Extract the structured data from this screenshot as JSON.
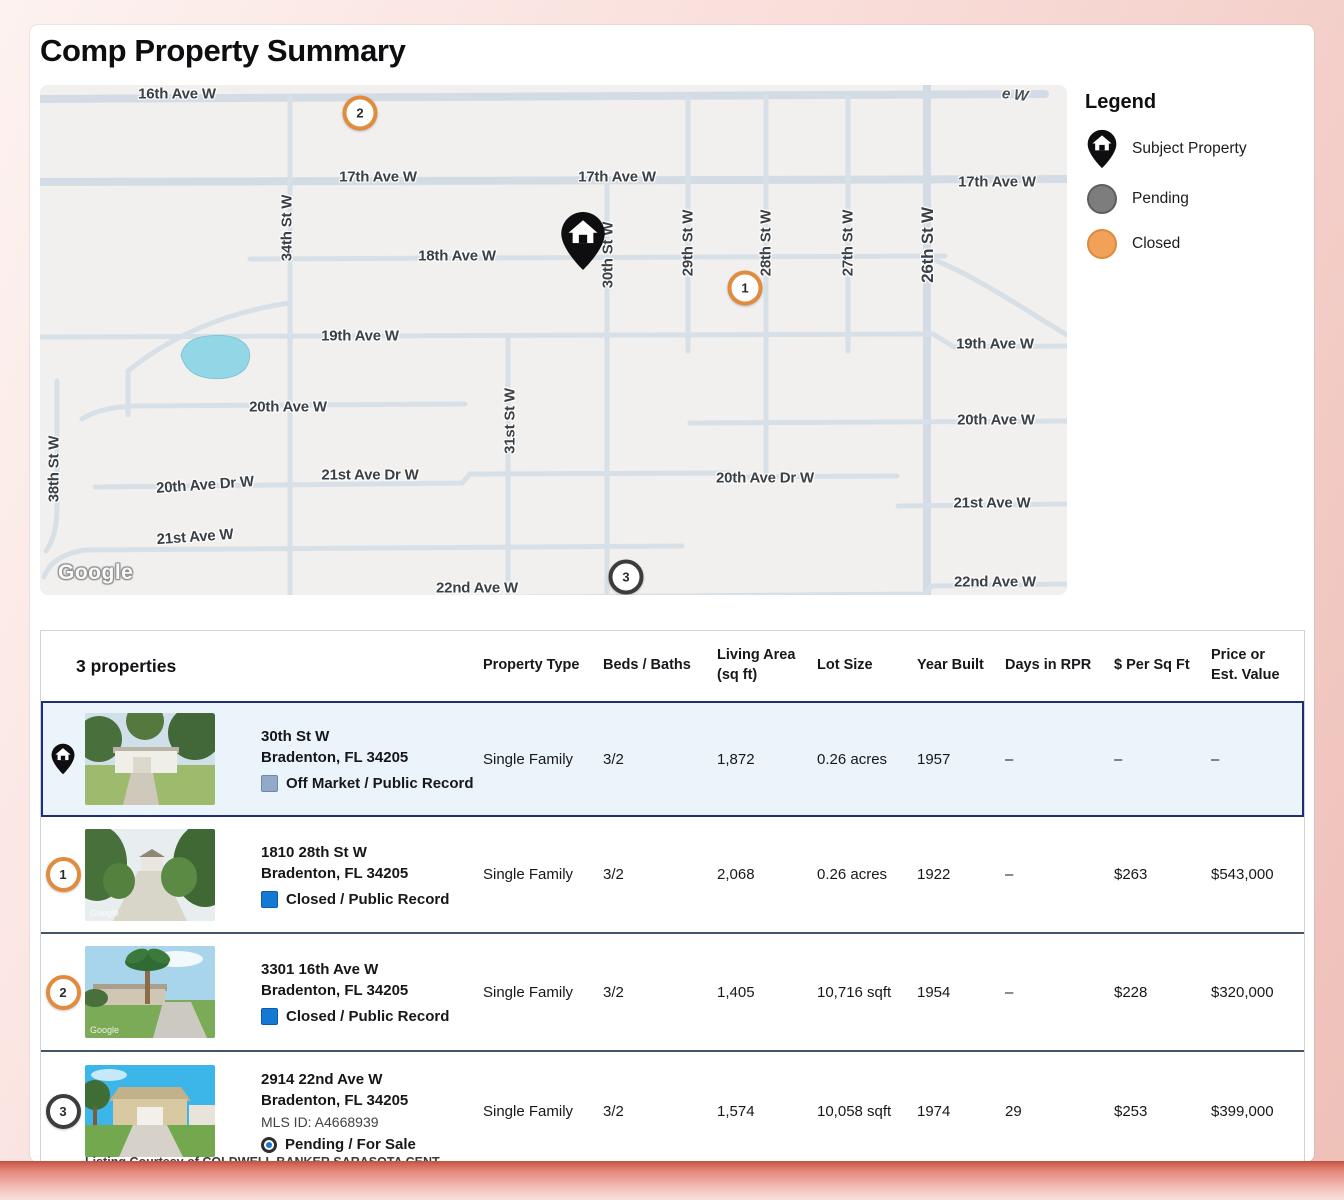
{
  "page_title": "Comp Property Summary",
  "map": {
    "google_logo": "Google",
    "street_labels": [
      "16th Ave W",
      "e W",
      "17th Ave W",
      "17th Ave W",
      "17th Ave W",
      "18th Ave W",
      "19th Ave W",
      "19th Ave W",
      "20th Ave W",
      "20th Ave W",
      "20th Ave Dr W",
      "21st Ave Dr W",
      "20th Ave Dr W",
      "21st Ave W",
      "21st Ave W",
      "22nd Ave W",
      "22nd Ave W",
      "38th St W",
      "34th St W",
      "31st St W",
      "30th St W",
      "29th St W",
      "28th St W",
      "27th St W",
      "26th St W"
    ],
    "markers": [
      {
        "label": "1",
        "status": "closed"
      },
      {
        "label": "2",
        "status": "closed"
      },
      {
        "label": "3",
        "status": "pending"
      }
    ]
  },
  "legend": {
    "title": "Legend",
    "items": [
      {
        "icon": "subject-pin",
        "label": "Subject Property"
      },
      {
        "icon": "pending-circle",
        "label": "Pending"
      },
      {
        "icon": "closed-circle",
        "label": "Closed"
      }
    ]
  },
  "colors": {
    "closed_orange": "#e08c3f",
    "pending_gray": "#7d7d7d",
    "selected_row_blue": "#ecf4fb",
    "selection_border_navy": "#1f2d7a"
  },
  "table": {
    "count_label": "3 properties",
    "columns": [
      [
        "Property Type",
        ""
      ],
      [
        "Beds / Baths",
        ""
      ],
      [
        "Living Area",
        "(sq ft)"
      ],
      [
        "Lot Size",
        ""
      ],
      [
        "Year Built",
        ""
      ],
      [
        "Days in RPR",
        ""
      ],
      [
        "$ Per Sq Ft",
        ""
      ],
      [
        "Price or",
        "Est. Value"
      ]
    ],
    "rows": [
      {
        "marker_label": "",
        "address_line1": "30th St W",
        "address_line2": "Bradenton, FL 34205",
        "status": "Off Market / Public Record",
        "property_type": "Single Family",
        "beds_baths": "3/2",
        "living_area": "1,872",
        "lot_size": "0.26 acres",
        "year_built": "1957",
        "days_in_rpr": "–",
        "price_per_sqft": "–",
        "price": "–"
      },
      {
        "marker_label": "1",
        "address_line1": "1810 28th St W",
        "address_line2": "Bradenton, FL 34205",
        "status": "Closed / Public Record",
        "property_type": "Single Family",
        "beds_baths": "3/2",
        "living_area": "2,068",
        "lot_size": "0.26 acres",
        "year_built": "1922",
        "days_in_rpr": "–",
        "price_per_sqft": "$263",
        "price": "$543,000"
      },
      {
        "marker_label": "2",
        "address_line1": "3301 16th Ave W",
        "address_line2": "Bradenton, FL 34205",
        "status": "Closed / Public Record",
        "property_type": "Single Family",
        "beds_baths": "3/2",
        "living_area": "1,405",
        "lot_size": "10,716 sqft",
        "year_built": "1954",
        "days_in_rpr": "–",
        "price_per_sqft": "$228",
        "price": "$320,000"
      },
      {
        "marker_label": "3",
        "address_line1": "2914 22nd Ave W",
        "address_line2": "Bradenton, FL 34205",
        "mls_id": "MLS ID: A4668939",
        "status": "Pending / For Sale",
        "courtesy": "Listing Courtesy of COLDWELL BANKER SARASOTA CENT",
        "property_type": "Single Family",
        "beds_baths": "3/2",
        "living_area": "1,574",
        "lot_size": "10,058 sqft",
        "year_built": "1974",
        "days_in_rpr": "29",
        "price_per_sqft": "$253",
        "price": "$399,000"
      }
    ]
  }
}
